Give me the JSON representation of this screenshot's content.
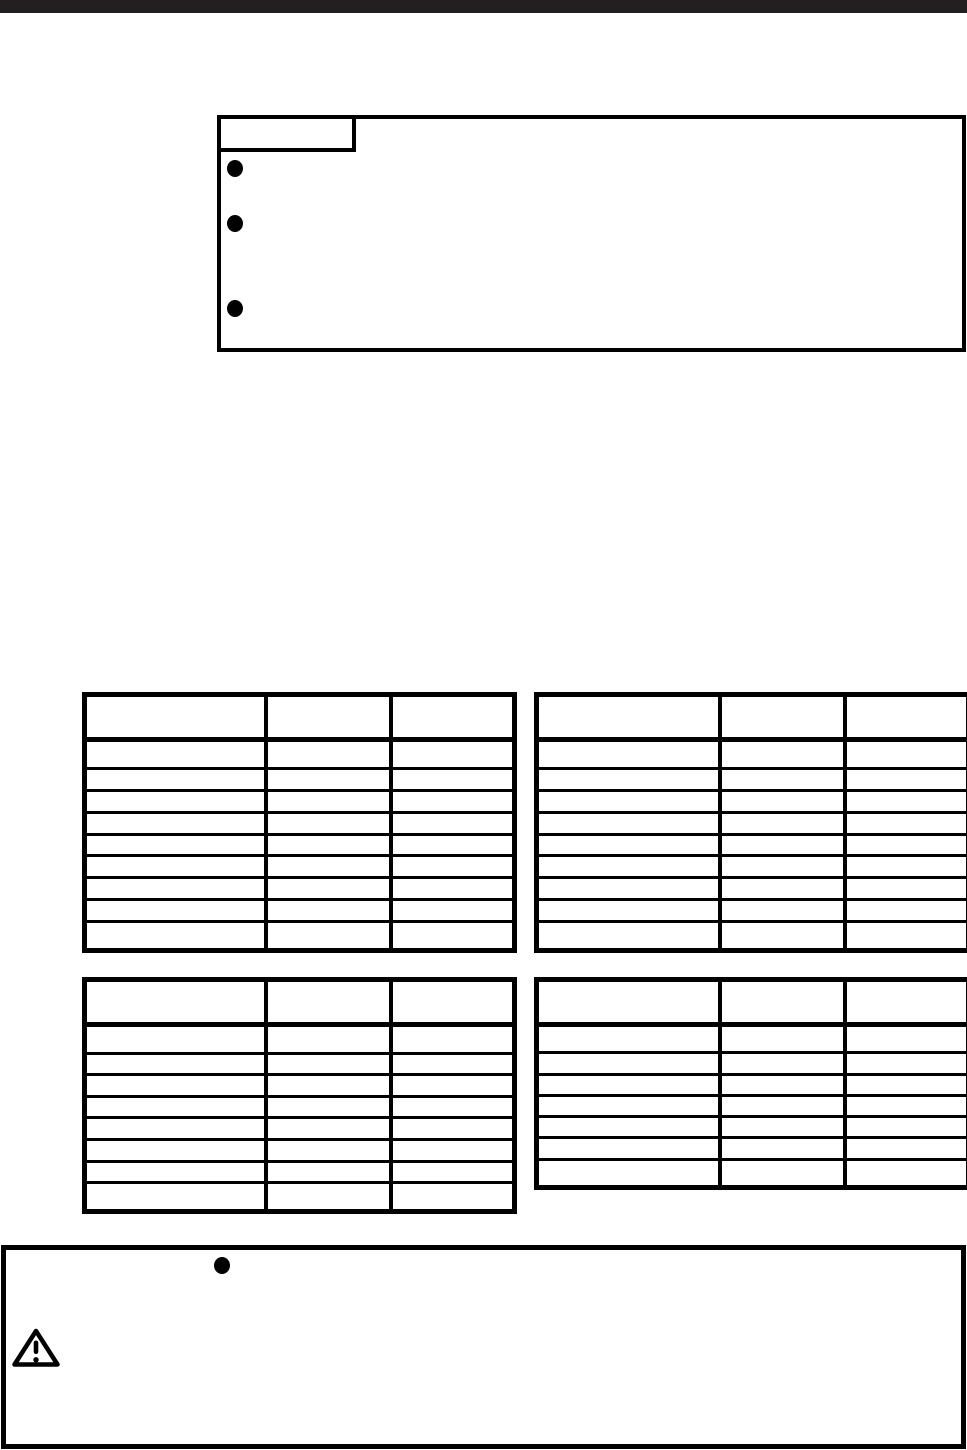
{
  "page": {
    "kind": "scanned-manual-page",
    "background": "#ffffff",
    "ink_color": "#000000",
    "top_bar_color": "#231f20"
  },
  "notice_box": {
    "title": "",
    "bullets": [
      "",
      "",
      ""
    ]
  },
  "tables": {
    "top_left": {
      "headers": [
        "",
        "",
        ""
      ],
      "rows": [
        [
          "",
          "",
          ""
        ],
        [
          "",
          "",
          ""
        ],
        [
          "",
          "",
          ""
        ],
        [
          "",
          "",
          ""
        ],
        [
          "",
          "",
          ""
        ],
        [
          "",
          "",
          ""
        ],
        [
          "",
          "",
          ""
        ],
        [
          "",
          "",
          ""
        ],
        [
          "",
          "",
          ""
        ]
      ]
    },
    "top_right": {
      "headers": [
        "",
        "",
        ""
      ],
      "rows": [
        [
          "",
          "",
          ""
        ],
        [
          "",
          "",
          ""
        ],
        [
          "",
          "",
          ""
        ],
        [
          "",
          "",
          ""
        ],
        [
          "",
          "",
          ""
        ],
        [
          "",
          "",
          ""
        ],
        [
          "",
          "",
          ""
        ],
        [
          "",
          "",
          ""
        ],
        [
          "",
          "",
          ""
        ]
      ]
    },
    "bottom_left": {
      "headers": [
        "",
        "",
        ""
      ],
      "rows": [
        [
          "",
          "",
          ""
        ],
        [
          "",
          "",
          ""
        ],
        [
          "",
          "",
          ""
        ],
        [
          "",
          "",
          ""
        ],
        [
          "",
          "",
          ""
        ],
        [
          "",
          "",
          ""
        ],
        [
          "",
          "",
          ""
        ],
        [
          "",
          "",
          ""
        ]
      ]
    },
    "bottom_right": {
      "headers": [
        "",
        "",
        ""
      ],
      "rows": [
        [
          "",
          "",
          ""
        ],
        [
          "",
          "",
          ""
        ],
        [
          "",
          "",
          ""
        ],
        [
          "",
          "",
          ""
        ],
        [
          "",
          "",
          ""
        ],
        [
          "",
          "",
          ""
        ],
        [
          "",
          "",
          ""
        ]
      ]
    }
  },
  "caution_box": {
    "bullets": [
      ""
    ]
  },
  "icons": {
    "bullet": "●",
    "warning_triangle": "⚠"
  }
}
